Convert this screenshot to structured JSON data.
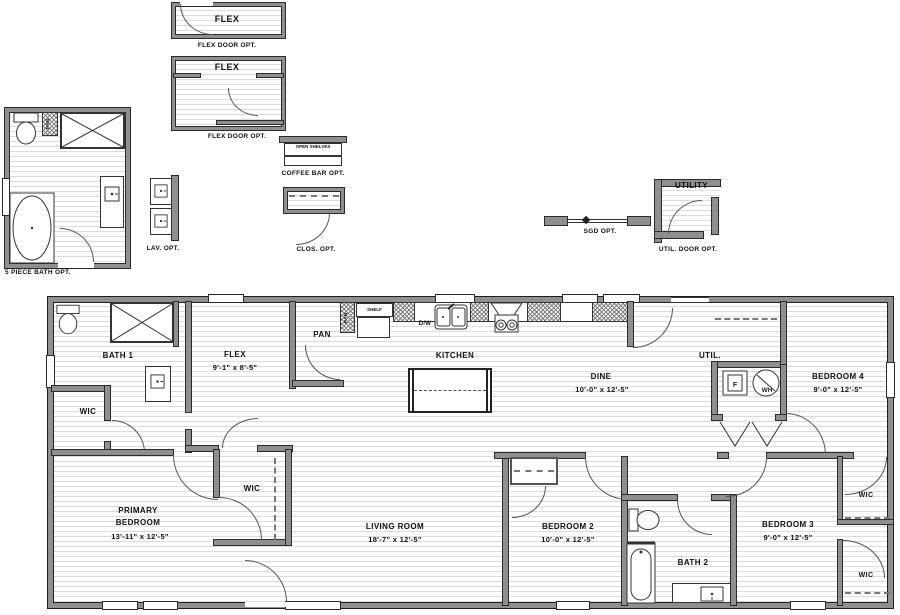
{
  "details": {
    "flex_a": {
      "room_label": "FLEX",
      "caption": "FLEX DOOR OPT."
    },
    "flex_b": {
      "room_label": "FLEX",
      "caption": "FLEX DOOR OPT."
    },
    "bath5": {
      "caption": "5 PIECE BATH OPT.",
      "pan_label": "PAN"
    },
    "coffee": {
      "shelves_label": "OPEN SHELVES",
      "caption": "COFFEE BAR OPT."
    },
    "lav": {
      "caption": "LAV. OPT."
    },
    "clos": {
      "caption": "CLOS. OPT."
    },
    "sgd": {
      "caption": "SGD OPT."
    },
    "util": {
      "room_label": "UTILITY",
      "caption": "UTIL. DOOR OPT."
    }
  },
  "plan": {
    "bath1": {
      "name": "BATH 1"
    },
    "wic_bath": {
      "name": "WIC"
    },
    "flex": {
      "name": "FLEX",
      "dims": "9'-1\" x 8'-5\""
    },
    "pantry": {
      "name": "PAN"
    },
    "kitchen": {
      "name": "KITCHEN",
      "pan": "PAN",
      "shelf": "SHELF",
      "dw": "D/W"
    },
    "dine": {
      "name": "DINE",
      "dims": "10'-0\" x 12'-5\""
    },
    "util": {
      "name": "UTIL.",
      "furnace": "F",
      "water_heater": "WH"
    },
    "bedroom4": {
      "name": "BEDROOM 4",
      "dims": "9'-0\" x 12'-5\""
    },
    "primary": {
      "name_line1": "PRIMARY",
      "name_line2": "BEDROOM",
      "dims": "13'-11\" x 12'-5\""
    },
    "primary_wic": {
      "name": "WIC"
    },
    "living": {
      "name": "LIVING ROOM",
      "dims": "18'-7\" x 12'-5\""
    },
    "bedroom2": {
      "name": "BEDROOM 2",
      "dims": "10'-0\" x 12'-5\""
    },
    "bath2": {
      "name": "BATH 2"
    },
    "bedroom3": {
      "name": "BEDROOM 3",
      "dims": "9'-0\" x 12'-5\""
    },
    "wic3_top": {
      "name": "WIC"
    },
    "wic3_bottom": {
      "name": "WIC"
    }
  },
  "colors": {
    "wall": "#8f8f8f",
    "line": "#1a1a1a",
    "hatch": "#dcdcdc",
    "background": "#ffffff"
  }
}
